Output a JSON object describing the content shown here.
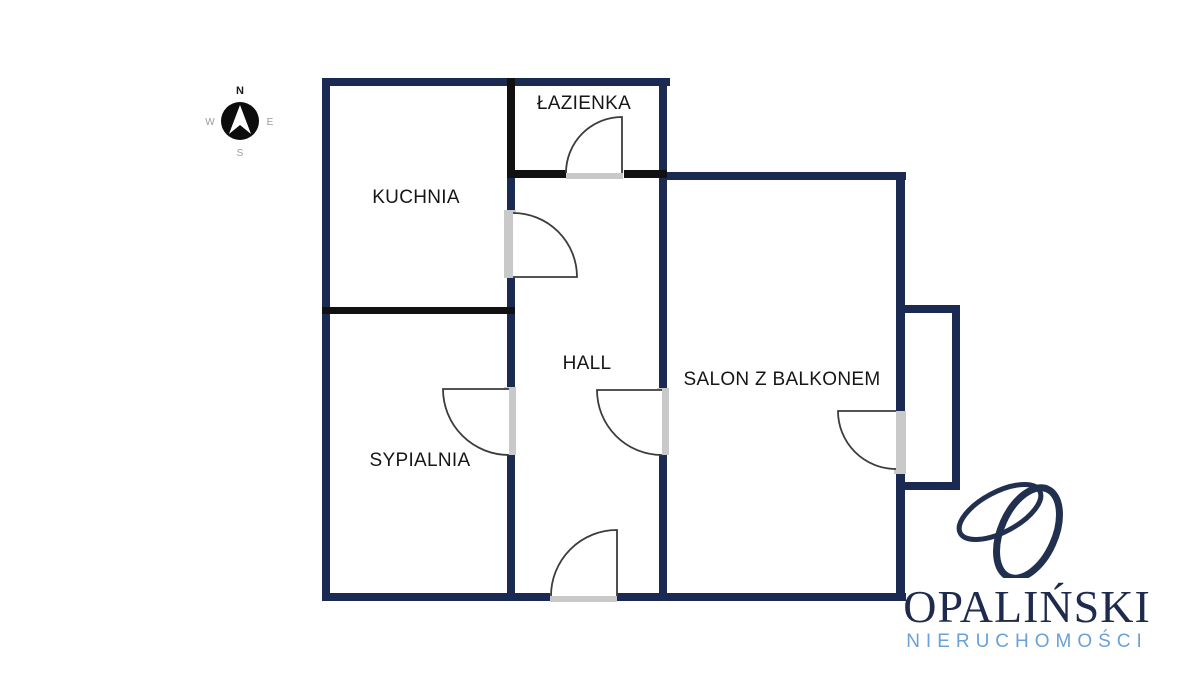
{
  "compass": {
    "north": "N",
    "south": "S",
    "east": "E",
    "west": "W"
  },
  "floorplan": {
    "rooms": [
      {
        "id": "bathroom",
        "label": "ŁAZIENKA"
      },
      {
        "id": "kitchen",
        "label": "KUCHNIA"
      },
      {
        "id": "hall",
        "label": "HALL"
      },
      {
        "id": "bedroom",
        "label": "SYPIALNIA"
      },
      {
        "id": "living-room",
        "label": "SALON Z BALKONEM"
      }
    ]
  },
  "branding": {
    "monogram": "O",
    "company": "OPALIŃSKI",
    "tagline": "NIERUCHOMOŚCI"
  },
  "colors": {
    "outer_wall_navy": "#1b2a52",
    "partition_black": "#111111",
    "door_sill_gray": "#c9c9c9",
    "door_arc_gray": "#3c3c3c",
    "brand_navy": "#1f2b4e",
    "brand_light_blue": "#6ba0d8",
    "compass_black": "#0d0d0d",
    "compass_letter_gray": "#9a9a9a"
  }
}
